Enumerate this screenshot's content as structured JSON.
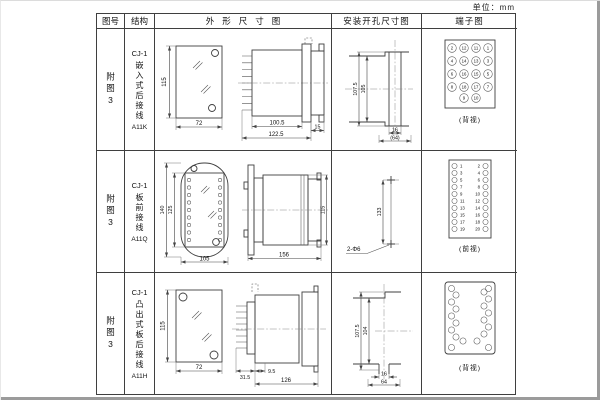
{
  "page": {
    "unit_label": "单位：mm"
  },
  "table": {
    "headers": {
      "figure_no": "图号",
      "structure": "结构",
      "outline": "外形尺寸图",
      "install": "安装开孔尺寸图",
      "terminal": "端子图"
    }
  },
  "rows": [
    {
      "figure_no": "附图3",
      "structure": {
        "model": "CJ-1",
        "type": "嵌入式后接线",
        "code": "A11K"
      },
      "outline": {
        "front_height": "115",
        "front_width": "72",
        "side_body": "100.5",
        "side_overall": "122.5",
        "side_flange": "15"
      },
      "install": {
        "outer_height": "107.5",
        "inner_height": "105",
        "slot_width": "16",
        "span": "(64)"
      },
      "terminal": {
        "view": "(背视)",
        "numbers": [
          "2",
          "12",
          "11",
          "1",
          "4",
          "14",
          "13",
          "3",
          "6",
          "16",
          "15",
          "5",
          "8",
          "18",
          "17",
          "7",
          "9",
          "10"
        ]
      }
    },
    {
      "figure_no": "附图3",
      "structure": {
        "model": "CJ-1",
        "type": "板前接线",
        "code": "A11Q"
      },
      "outline": {
        "front_outer_height": "140",
        "front_inner_height": "125",
        "front_width": "105",
        "side_length": "156",
        "side_height": "115"
      },
      "install": {
        "hole_spacing": "133",
        "hole_label": "2-Φ6"
      },
      "terminal": {
        "view": "(前视)",
        "left_numbers": [
          "1",
          "3",
          "5",
          "7",
          "9",
          "11",
          "13",
          "15",
          "17",
          "19"
        ],
        "right_numbers": [
          "2",
          "4",
          "6",
          "8",
          "10",
          "12",
          "14",
          "16",
          "18",
          "20"
        ]
      }
    },
    {
      "figure_no": "附图3",
      "structure": {
        "model": "CJ-1",
        "type": "凸出式板后接线",
        "code": "A11H"
      },
      "outline": {
        "front_height": "115",
        "front_width": "72",
        "side_pins": "31.5",
        "side_gap": "9.5",
        "side_length": "126"
      },
      "install": {
        "outer_height": "107.5",
        "inner_height": "104",
        "slot_width": "16",
        "span": "64"
      },
      "terminal": {
        "view": "(背视)"
      }
    }
  ]
}
